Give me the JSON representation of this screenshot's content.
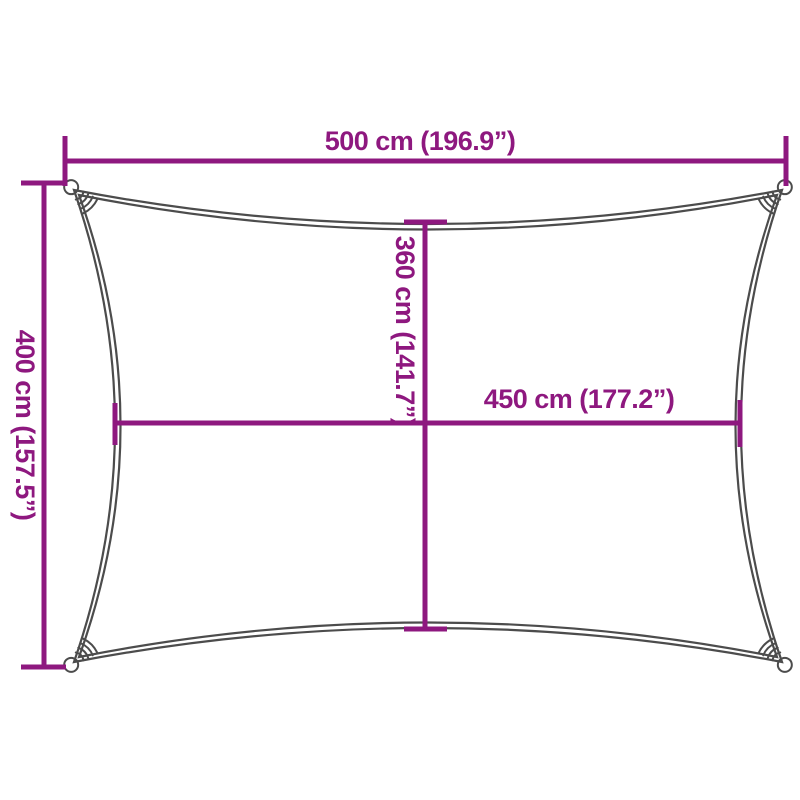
{
  "diagram": {
    "name": "shade-sail-dimension-diagram",
    "dimensions": {
      "width": {
        "label": "500 cm (196.9”)"
      },
      "height": {
        "label": "400 cm (157.5”)"
      },
      "inner_height": {
        "label": "360 cm (141.7”)"
      },
      "inner_width": {
        "label": "450 cm (177.2”)"
      }
    },
    "colors": {
      "dimension": "#8E187F",
      "outline": "#4C4C4C",
      "background": "#FFFFFF"
    }
  }
}
